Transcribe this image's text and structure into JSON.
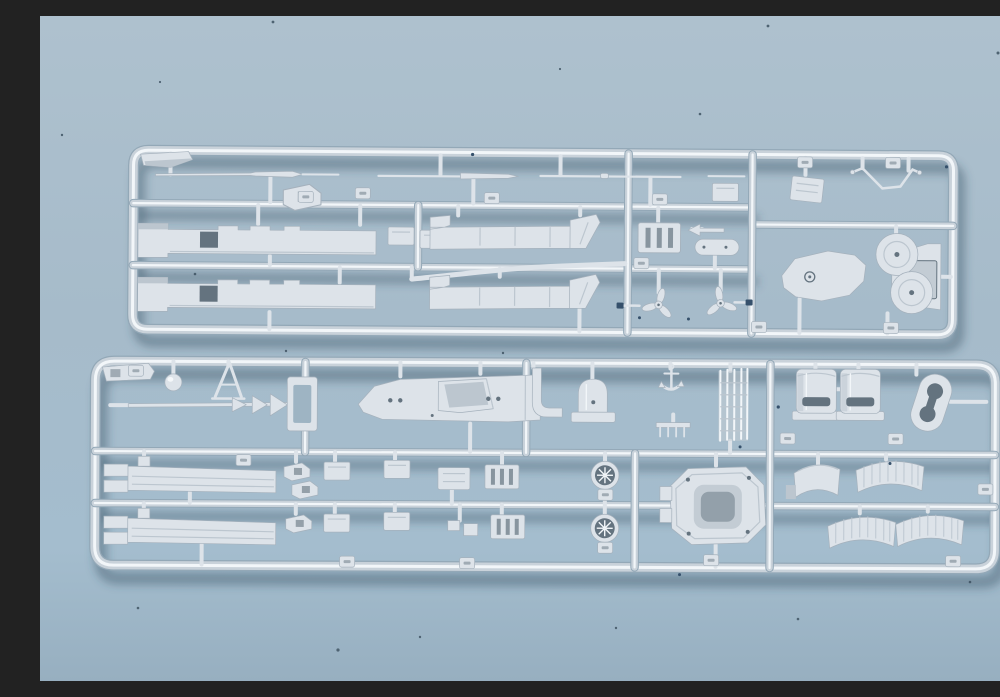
{
  "meta": {
    "type": "photograph",
    "subject": "Two light-gray injection-molded plastic model kit sprues (runners holding ship model parts) photographed on a plain light blue background with small dust specks",
    "orientation": "landscape"
  },
  "palette": {
    "bgTop": "#aec1ce",
    "bgMid": "#a6bbca",
    "bgLow": "#a4bdce",
    "bgBot": "#97afc0",
    "shadow": "rgba(47,72,92,0.40)",
    "tubeUnder": "#93a8b7",
    "tubeOuter": "#c9d2da",
    "tubeInner": "#f2f6f9",
    "plastic": "#dde3e9",
    "plasticEdge": "#a5b1bc",
    "plasticShadow": "#bcc6cf",
    "recess": "#c3ccd4",
    "recessDark": "#64737f",
    "bgThrough": "#9eb4c3",
    "speck": "#4e6372",
    "darkMark": "#35506b",
    "highlight": "#f7fafc"
  },
  "scene": {
    "background": "plain light blue painted surface, soft gradient, scattered dust specks",
    "sprues": [
      {
        "id": "top-sprue",
        "description": "long horizontal runner frame with three rows of cells",
        "parts": [
          "angled corner plate",
          "mast rod with tapered section",
          "equipment bracket",
          "rod with tapered gun barrel",
          "antenna rod",
          "short rod",
          "hull side strip with cutout (x2)",
          "strip with angled end bracket (x2)",
          "bent handrail pipe",
          "vented equipment box",
          "small dart vane",
          "pill shaped fitting",
          "three-blade propeller with shaft (x2)",
          "mounting plate",
          "v-shaped davit wire",
          "catapult base with two turntables and pedestal tower",
          "part number tabs"
        ]
      },
      {
        "id": "bottom-sprue",
        "description": "long horizontal runner frame with deck, funnels, barbette and fittings",
        "parts": [
          "angle bracket strip",
          "rangefinder ball",
          "A-frame mast",
          "yard spar with three sail vanes",
          "rectangular frame",
          "superstructure deck with casemate and portholes",
          "J-shaped pipe",
          "domed funnel casing",
          "anchor",
          "comb grate",
          "inclined ladder rails",
          "funnel casing (x2)",
          "kidney-shaped platform with opening",
          "walkway strip with end tabs (x2)",
          "clip fittings",
          "small plates",
          "equipment box",
          "vent grille plate (x2)",
          "round funnel grate (x2)",
          "octagonal barbette platform",
          "curved splinter shield (x4)",
          "part number tabs"
        ]
      }
    ]
  }
}
